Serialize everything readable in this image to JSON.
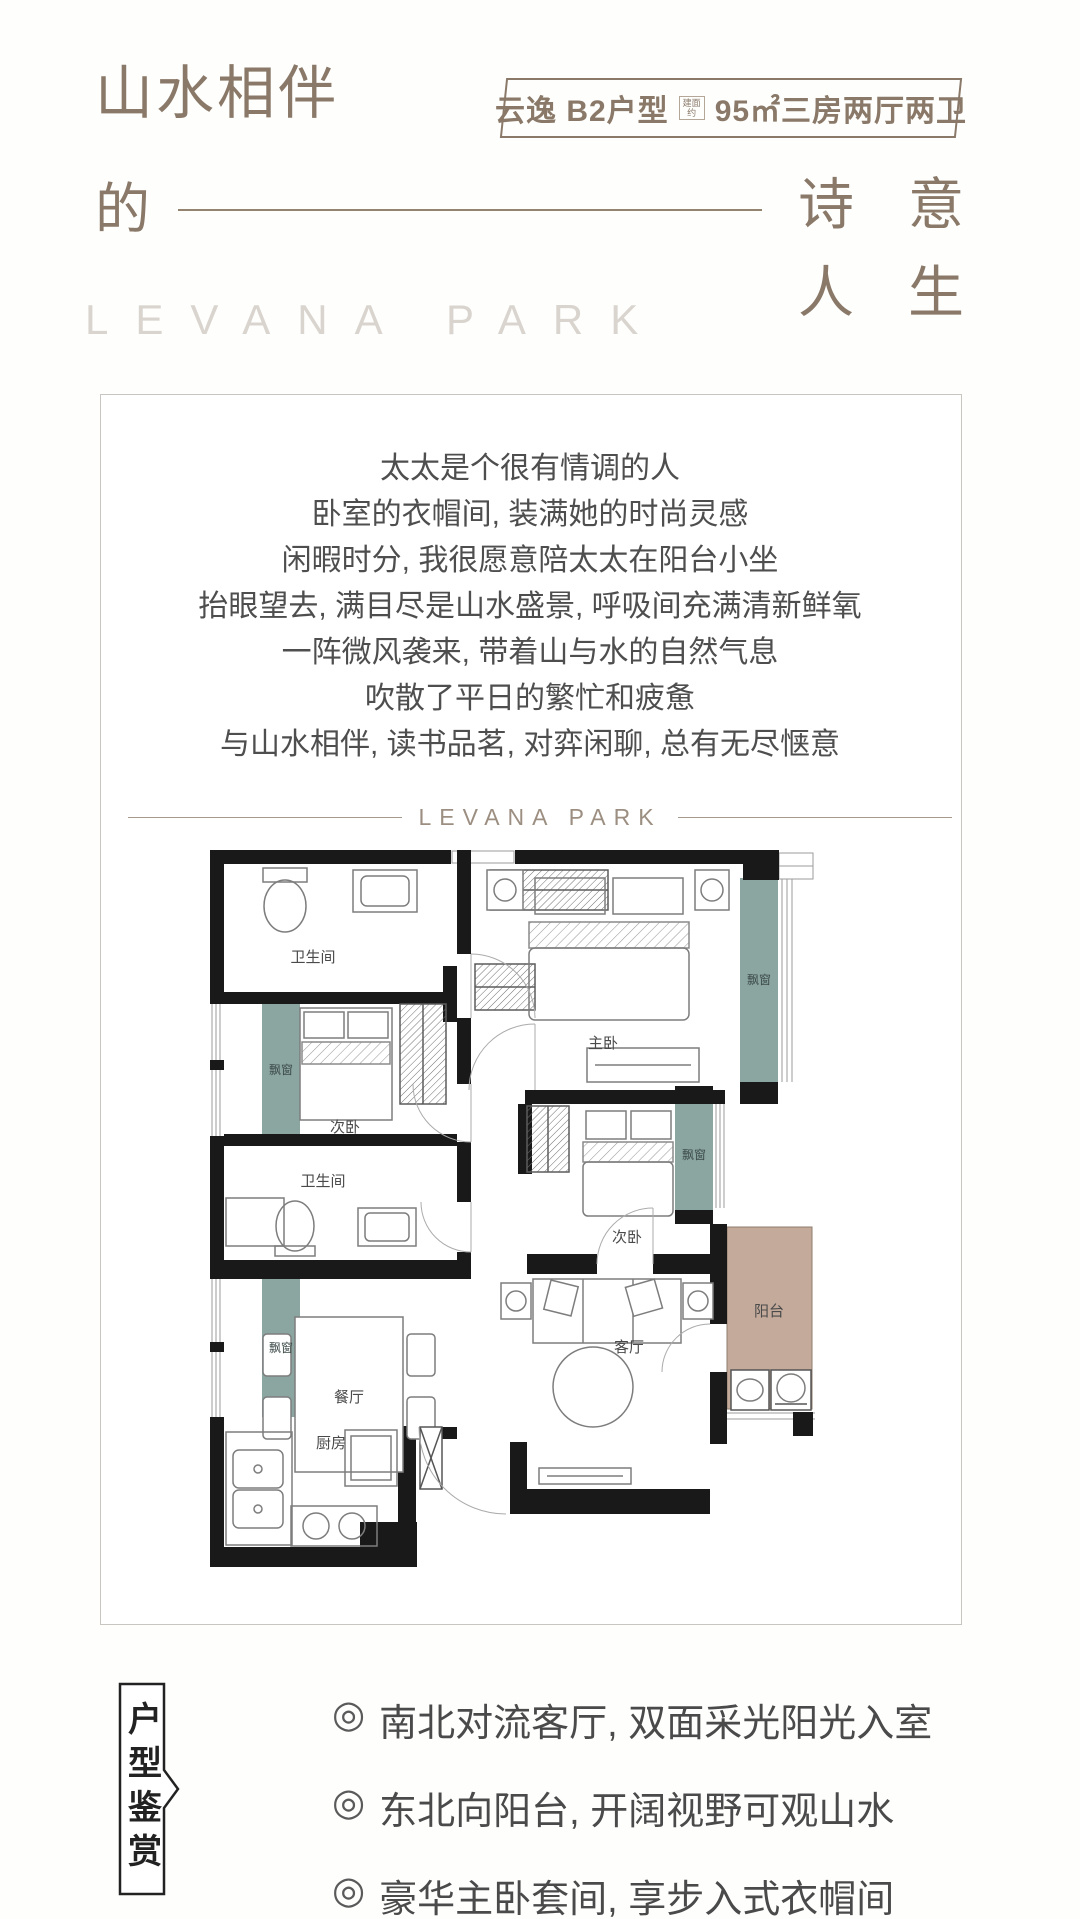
{
  "header": {
    "title_line1": "山水相伴",
    "title_line2": "的",
    "slogan_rows": [
      [
        "诗",
        "意"
      ],
      [
        "人",
        "生"
      ]
    ],
    "watermark": "LEVANA PARK",
    "badge": {
      "name": "云逸 B2户型",
      "area_prefix": "建面约",
      "spec": "95㎡三房两厅两卫"
    }
  },
  "card": {
    "paragraph": [
      "太太是个很有情调的人",
      "卧室的衣帽间, 装满她的时尚灵感",
      "闲暇时分, 我很愿意陪太太在阳台小坐",
      "抬眼望去, 满目尽是山水盛景, 呼吸间充满清新鲜氧",
      "一阵微风袭来, 带着山与水的自然气息",
      "吹散了平日的繁忙和疲惫",
      "与山水相伴, 读书品茗, 对弈闲聊, 总有无尽惬意"
    ],
    "divider_label": "LEVANA PARK"
  },
  "floor_plan": {
    "rooms": {
      "bathroom_top": "卫生间",
      "bedroom_left": "次卧",
      "bathroom_mid": "卫生间",
      "dining": "餐厅",
      "kitchen": "厨房",
      "master": "主卧",
      "bedroom_right": "次卧",
      "living": "客厅",
      "balcony": "阳台"
    },
    "bay_window": "飘窗",
    "colors": {
      "wall": "#191919",
      "bay_window": "#8ba6a1",
      "balcony": "#c3aa9b"
    }
  },
  "footer": {
    "tag": "户型鉴赏",
    "bullet_marker": "◎",
    "bullets": [
      "南北对流客厅, 双面采光阳光入室",
      "东北向阳台, 开阔视野可观山水",
      "豪华主卧套间, 享步入式衣帽间"
    ]
  },
  "colors": {
    "accent_brown": "#8a7968",
    "watermark_gray": "#d9d4ce",
    "text_dark": "#4e4e4e",
    "card_border": "#c9c6c2"
  }
}
